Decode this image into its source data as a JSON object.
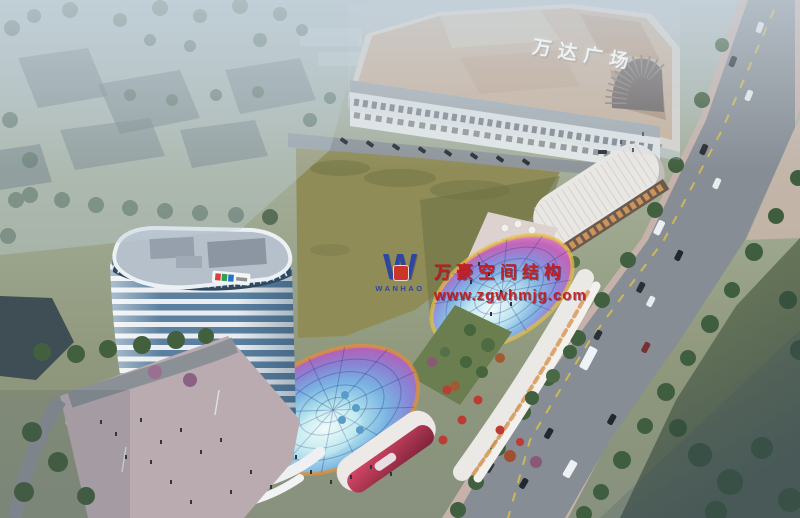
{
  "mall": {
    "sign_text": "万达广场",
    "sign_color": "#f2f6f8"
  },
  "watermark": {
    "company_cn": "万豪空间结构",
    "company_en": "WANHAO",
    "logo_letter": "W",
    "website": "www.zgwhmjg.com",
    "text_color": "#c41818",
    "logo_color": "#2840a8"
  },
  "palette": {
    "haze": "#c3d2dc",
    "field_green": "#8f8c58",
    "field_shadow": "#6e7144",
    "road_gray": "#878d94",
    "sidewalk_pink": "#c6b2ab",
    "tree_green": "#41603f",
    "lawn_green": "#6e7d52",
    "mall_roof_tan": "#c6a98c",
    "mall_facade": "#d8d2c8",
    "tower_band_white": "#e9edf1",
    "tower_glass_blue": "#5a7f9f",
    "warm_glow": "#d99a58",
    "plaza_pink": "#b9abb0",
    "dark_building": "#3f4d55",
    "canopy_yellow_rim": "#e8c040",
    "red_glass": "#c83858"
  }
}
